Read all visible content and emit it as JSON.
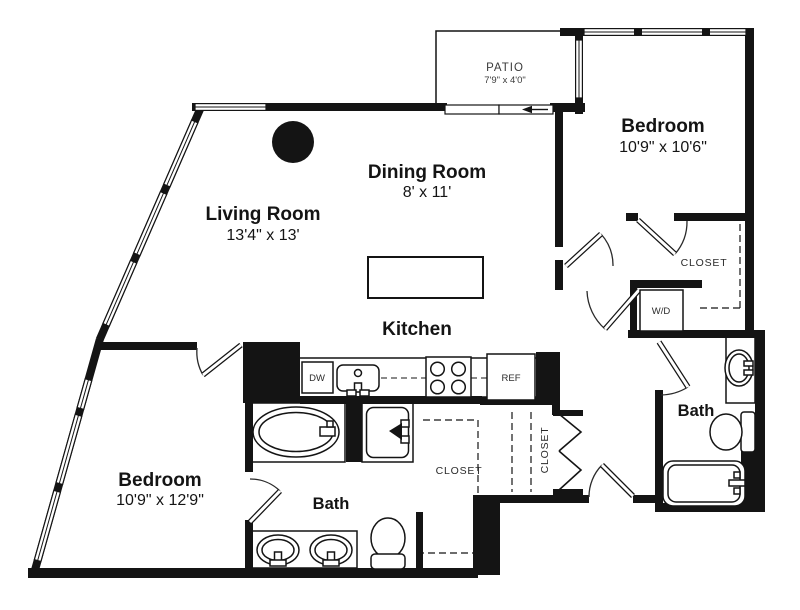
{
  "rooms": {
    "living": {
      "name": "Living Room",
      "dims": "13'4\" x 13'"
    },
    "dining": {
      "name": "Dining Room",
      "dims": "8' x 11'"
    },
    "kitchen": {
      "name": "Kitchen"
    },
    "bedroom_right": {
      "name": "Bedroom",
      "dims": "10'9\" x 10'6\""
    },
    "bedroom_left": {
      "name": "Bedroom",
      "dims": "10'9\" x 12'9\""
    },
    "bath_right": {
      "name": "Bath"
    },
    "bath_lower": {
      "name": "Bath"
    },
    "patio": {
      "name": "PATIO",
      "dims": "7'9\" x 4'0\""
    }
  },
  "closets": {
    "upper_right": "CLOSET",
    "hallway": "CLOSET",
    "walk_in": "CLOSET"
  },
  "appliances": {
    "washer_dryer": "W/D",
    "dishwasher": "DW",
    "refrigerator": "REF"
  },
  "colors": {
    "wall": "#141414",
    "background": "#ffffff"
  }
}
